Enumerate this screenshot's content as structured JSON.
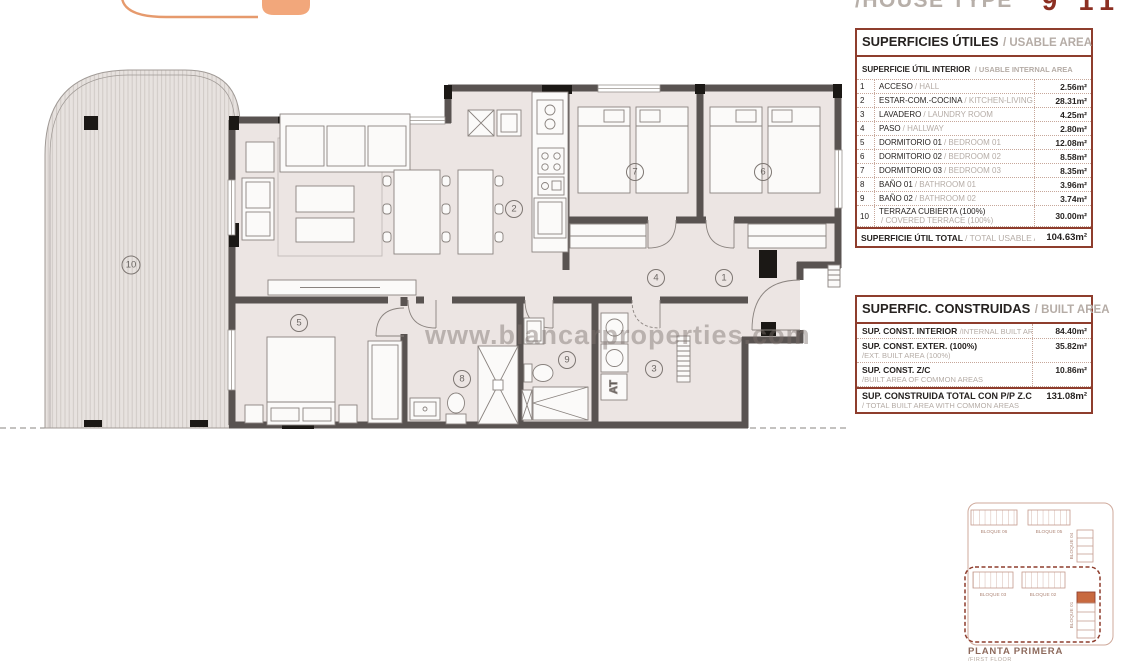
{
  "header": {
    "house_type_label": "/HOUSE TYPE",
    "house_code": "9 11"
  },
  "watermark": "www.blancarproperties.com",
  "plan": {
    "labels": [
      "1",
      "2",
      "3",
      "4",
      "5",
      "6",
      "7",
      "8",
      "9",
      "10"
    ],
    "at_label": "AT"
  },
  "tables": {
    "usable": {
      "title_es": "SUPERFICIES ÚTILES",
      "title_en": "/ USABLE AREA",
      "subtitle_es": "SUPERFICIE ÚTIL INTERIOR",
      "subtitle_en": "/ USABLE INTERNAL AREA",
      "rows": [
        {
          "num": "1",
          "es": "ACCESO",
          "en": "/ HALL",
          "value": "2.56m²"
        },
        {
          "num": "2",
          "es": "ESTAR-COM.-COCINA",
          "en": "/ KITCHEN-LIVING",
          "value": "28.31m²"
        },
        {
          "num": "3",
          "es": "LAVADERO",
          "en": "/ LAUNDRY ROOM",
          "value": "4.25m²"
        },
        {
          "num": "4",
          "es": "PASO",
          "en": "/ HALLWAY",
          "value": "2.80m²"
        },
        {
          "num": "5",
          "es": "DORMITORIO 01",
          "en": "/ BEDROOM 01",
          "value": "12.08m²"
        },
        {
          "num": "6",
          "es": "DORMITORIO 02",
          "en": "/ BEDROOM 02",
          "value": "8.58m²"
        },
        {
          "num": "7",
          "es": "DORMITORIO 03",
          "en": "/ BEDROOM 03",
          "value": "8.35m²"
        },
        {
          "num": "8",
          "es": "BAÑO 01",
          "en": "/ BATHROOM 01",
          "value": "3.96m²"
        },
        {
          "num": "9",
          "es": "BAÑO 02",
          "en": "/ BATHROOM 02",
          "value": "3.74m²"
        },
        {
          "num": "10",
          "es": "TERRAZA CUBIERTA (100%)",
          "en": "/ COVERED TERRACE (100%)",
          "value": "30.00m²"
        }
      ],
      "total_es": "SUPERFICIE ÚTIL TOTAL",
      "total_en": "/ TOTAL USABLE AREA",
      "total_value": "104.63m²"
    },
    "built": {
      "title_es": "SUPERFIC. CONSTRUIDAS",
      "title_en": "/ BUILT AREA",
      "rows": [
        {
          "es": "SUP. CONST. INTERIOR",
          "en": "/INTERNAL BUILT AREA",
          "value": "84.40m²"
        },
        {
          "es": "SUP. CONST. EXTER. (100%)",
          "en": "/EXT. BUILT AREA (100%)",
          "value": "35.82m²"
        },
        {
          "es": "SUP. CONST. Z/C",
          "en": "/BUILT AREA OF COMMON AREAS",
          "value": "10.86m²"
        }
      ],
      "total_es": "SUP. CONSTRUIDA TOTAL CON P/P Z.C",
      "total_en": "/ TOTAL BUILT AREA WITH COMMON AREAS",
      "total_value": "131.08m²"
    }
  },
  "keyplan": {
    "blocks": [
      "BLOQUE 06",
      "BLOQUE 05",
      "BLOQUE 04",
      "BLOQUE 03",
      "BLOQUE 02",
      "BLOQUE 01"
    ],
    "caption_es": "PLANTA PRIMERA",
    "caption_en": "/FIRST FLOOR"
  },
  "colors": {
    "accent_red": "#8e3d2d",
    "logo_orange": "#f2a77b",
    "wall_dark": "#595351",
    "floor": "#ece5e3",
    "highlight_orange": "#c8693f"
  }
}
